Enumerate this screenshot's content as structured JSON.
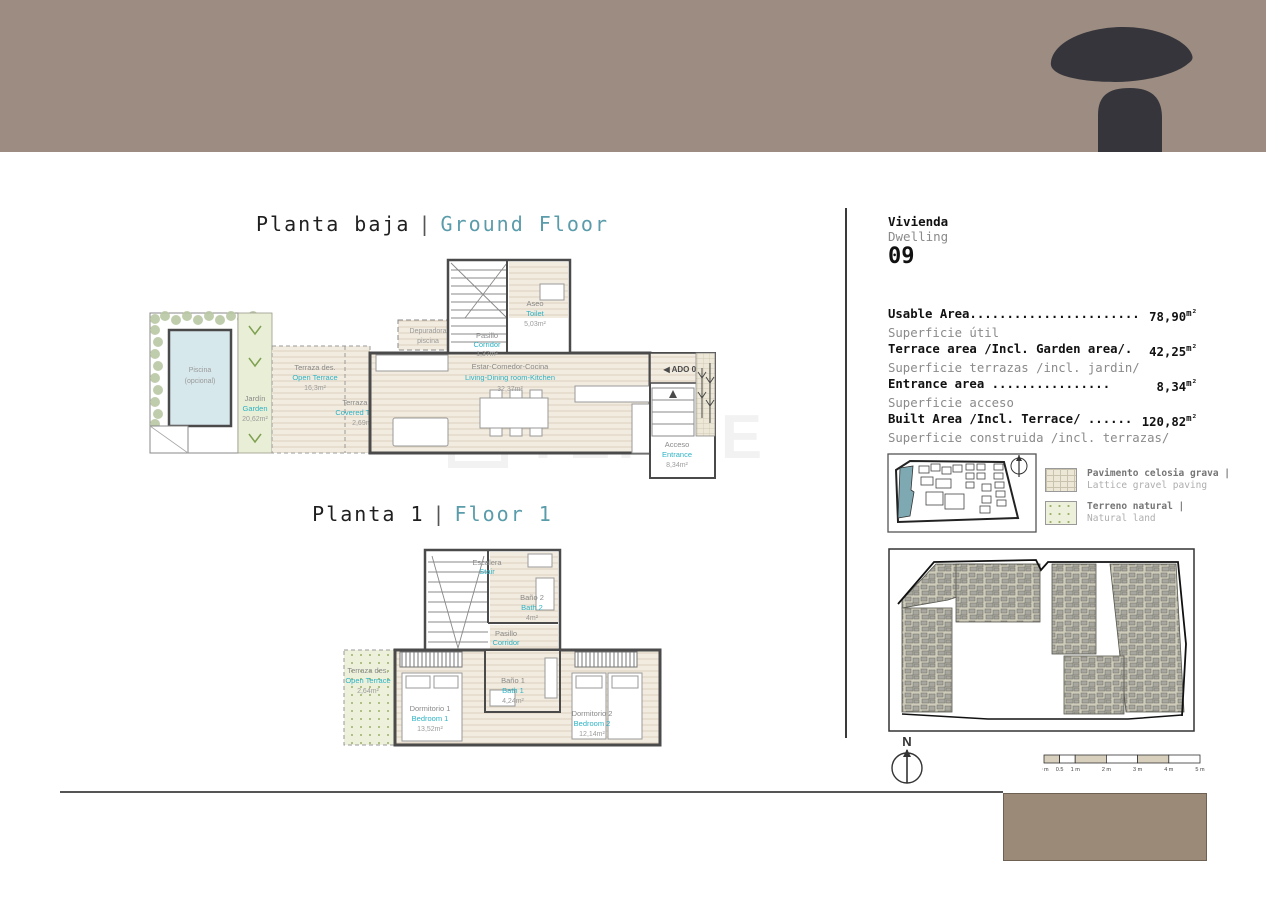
{
  "page": {
    "watermark": "TEKCE"
  },
  "colors": {
    "header_brown": "#9c8c81",
    "footer_brown": "#9c8a79",
    "logo_dark": "#35353b",
    "accent_teal": "#2eb3c5",
    "title_teal": "#5b9cab",
    "terrace_beige": "#f2ebdf",
    "garden_green": "#e9eed6",
    "pool_blue": "#d7e8ec"
  },
  "titles": {
    "ground": {
      "es": "Planta baja",
      "divider": "|",
      "en": "Ground Floor"
    },
    "floor1": {
      "es": "Planta 1",
      "divider": "|",
      "en": "Floor 1"
    }
  },
  "ground": {
    "pool": {
      "l1": "Piscina",
      "l2": "(opcional)"
    },
    "garden": {
      "es": "Jardín",
      "en": "Garden",
      "area": "20,62m²"
    },
    "open_terrace": {
      "es": "Terraza des.",
      "en": "Open Terrace",
      "area": "16,3m²"
    },
    "covered_terrace": {
      "es": "Terraza cub.",
      "en": "Covered Terrace",
      "area": "2,69m²"
    },
    "depuradora": {
      "l1": "Depuradora",
      "l2": "piscina"
    },
    "living": {
      "es": "Estar-Comedor-Cocina",
      "en": "Living-Dining room-Kitchen",
      "area": "32,37m²"
    },
    "hall": {
      "es": "Pasillo",
      "en": "Corridor",
      "area": "1,37m²"
    },
    "toilet": {
      "es": "Aseo",
      "en": "Toilet",
      "area": "5,03m²"
    },
    "entrance": {
      "es": "Acceso",
      "en": "Entrance",
      "area": "8,34m²"
    },
    "ado": "◀ ADO 09"
  },
  "floor1": {
    "stair": {
      "es": "Escalera",
      "en": "Stair"
    },
    "bath2": {
      "es": "Baño 2",
      "en": "Bath 2",
      "area": "4m²"
    },
    "hall": {
      "es": "Pasillo",
      "en": "Corridor",
      "area": "2,05m²"
    },
    "open_terrace": {
      "es": "Terraza des.",
      "en": "Open Terrace",
      "area": "2,64m²"
    },
    "bedroom1": {
      "es": "Dormitorio 1",
      "en": "Bedroom 1",
      "area": "13,52m²"
    },
    "bath1": {
      "es": "Baño 1",
      "en": "Bath 1",
      "area": "4,24m²"
    },
    "bedroom2": {
      "es": "Dormitorio 2",
      "en": "Bedroom 2",
      "area": "12,14m²"
    }
  },
  "panel": {
    "vivienda": "Vivienda",
    "dwelling": "Dwelling",
    "number": "09",
    "areas": [
      {
        "en": "Usable Area.......................",
        "es": "Superficie útil",
        "value": "78,90",
        "unit": "m²"
      },
      {
        "en": "Terrace area /Incl. Garden area/.",
        "es": "Superficie terrazas /incl. jardin/",
        "value": "42,25",
        "unit": "m²"
      },
      {
        "en": "Entrance area  ................",
        "es": "Superficie acceso",
        "value": "8,34",
        "unit": "m²"
      },
      {
        "en": "Built Area /Incl. Terrace/ ......",
        "es": "Superficie construida /incl. terrazas/",
        "value": "120,82",
        "unit": "m²"
      }
    ],
    "legend": [
      {
        "es": "Pavimento celosia grava |",
        "en": "Lattice gravel paving"
      },
      {
        "es": "Terreno natural |",
        "en": "Natural land"
      }
    ],
    "compass": "N",
    "scale_labels": [
      "0 m",
      "0.5",
      "1 m",
      "2 m",
      "3 m",
      "4 m",
      "5 m"
    ]
  }
}
